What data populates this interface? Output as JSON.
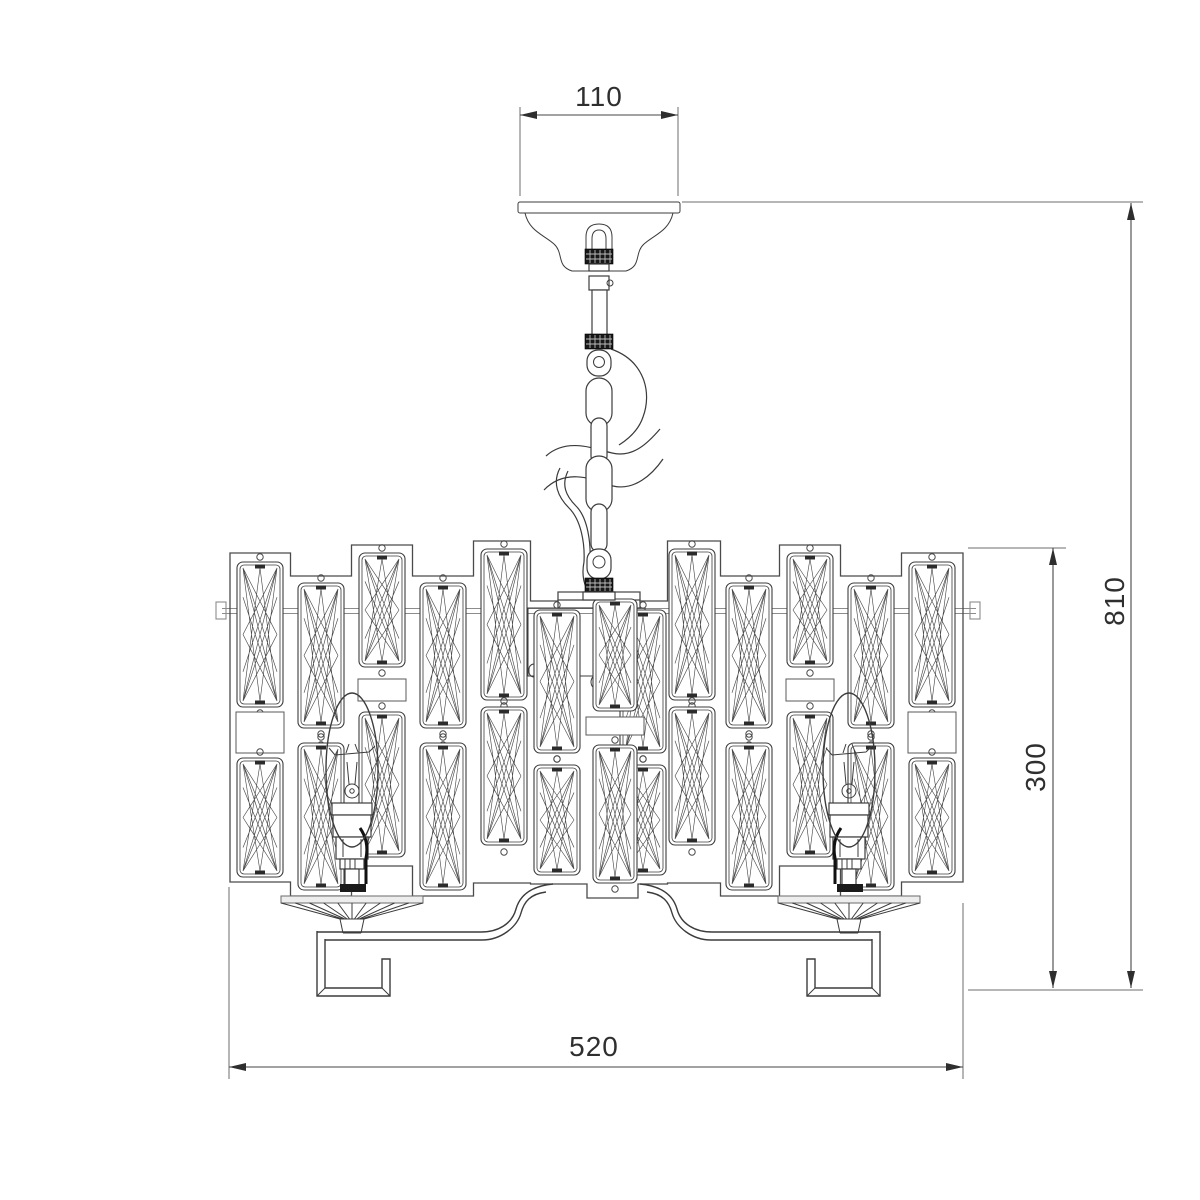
{
  "title": "chandelier-dimension-drawing",
  "dims": {
    "canopy_width": {
      "value": "110"
    },
    "overall_height": {
      "value": "810"
    },
    "body_height": {
      "value": "300"
    },
    "body_width": {
      "value": "520"
    }
  },
  "colors": {
    "line": "#3c3c3c",
    "light": "#8c8c8c",
    "dim_line": "#464646",
    "background": "#ffffff"
  },
  "drawing": {
    "body": {
      "left": 230,
      "right": 963
    },
    "columns": [
      {
        "x": 237,
        "w": 46,
        "t": 553,
        "b": 882,
        "u": [
          562,
          145
        ],
        "blank": [
          712,
          41
        ],
        "l": [
          758,
          119
        ]
      },
      {
        "x": 298,
        "w": 46,
        "t": 576,
        "b": 896,
        "u": [
          583,
          145
        ],
        "l": [
          743,
          147
        ],
        "d2": 1
      },
      {
        "x": 359,
        "w": 46,
        "t": 545,
        "b": 866,
        "u": [
          553,
          114
        ],
        "blank": [
          679,
          22
        ],
        "l": [
          712,
          145
        ]
      },
      {
        "x": 420,
        "w": 46,
        "t": 576,
        "b": 896,
        "u": [
          583,
          145
        ],
        "l": [
          743,
          147
        ],
        "d2": 1
      },
      {
        "x": 481,
        "w": 46,
        "t": 541,
        "b": 883,
        "u": [
          549,
          151
        ],
        "l": [
          707,
          138
        ]
      },
      {
        "x": 534,
        "w": 46,
        "t": 601,
        "b": 884,
        "u": [
          610,
          143
        ],
        "l": [
          765,
          110
        ]
      },
      {
        "x": 620,
        "w": 46,
        "t": 601,
        "b": 884,
        "u": [
          610,
          143
        ],
        "l": [
          765,
          110
        ]
      },
      {
        "x": 669,
        "w": 46,
        "t": 541,
        "b": 883,
        "u": [
          549,
          151
        ],
        "l": [
          707,
          138
        ]
      },
      {
        "x": 726,
        "w": 46,
        "t": 576,
        "b": 896,
        "u": [
          583,
          145
        ],
        "l": [
          743,
          147
        ],
        "d2": 1
      },
      {
        "x": 787,
        "w": 46,
        "t": 545,
        "b": 866,
        "u": [
          553,
          114
        ],
        "blank": [
          679,
          22
        ],
        "l": [
          712,
          145
        ]
      },
      {
        "x": 848,
        "w": 46,
        "t": 576,
        "b": 896,
        "u": [
          583,
          145
        ],
        "l": [
          743,
          147
        ],
        "d2": 1
      },
      {
        "x": 909,
        "w": 46,
        "t": 553,
        "b": 882,
        "u": [
          562,
          145
        ],
        "blank": [
          712,
          41
        ],
        "l": [
          758,
          119
        ]
      }
    ],
    "central": {
      "x": 593,
      "w": 44,
      "u": [
        599,
        112
      ],
      "blank": {
        "x": 586,
        "y": 717,
        "w": 58,
        "h": 18
      },
      "l": [
        745,
        138
      ]
    },
    "bulbs": [
      {
        "cx": 352,
        "mirror": 1
      },
      {
        "cx": 849,
        "mirror": -1
      }
    ]
  }
}
